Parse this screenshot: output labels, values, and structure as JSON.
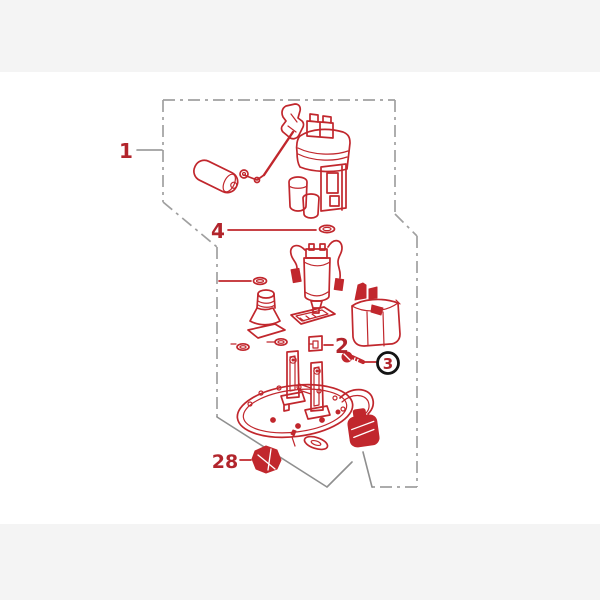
{
  "window": {
    "background": "#f4f4f4",
    "panel_background": "#ffffff"
  },
  "colors": {
    "part_line": "#c1272d",
    "part_fill": "#c1272d",
    "label_text": "#b2252c",
    "boundary": "#a0a0a0",
    "leader": "#8f8f8f",
    "callout_ring": "#141414",
    "background": "#f4f4f4",
    "panel": "#ffffff"
  },
  "diagram": {
    "kind": "exploded-parts-diagram",
    "subject": "fuel-pump-module-assembly",
    "callouts": [
      {
        "label": "1",
        "circled": false
      },
      {
        "label": "4",
        "circled": false
      },
      {
        "label": "2",
        "circled": false
      },
      {
        "label": "3",
        "circled": true
      },
      {
        "label": "28",
        "circled": false
      }
    ],
    "parts": [
      "pump-module-body",
      "fuel-level-float",
      "inner-fuel-pump",
      "strainer-joint",
      "filter-case",
      "o-rings",
      "retainer-clip",
      "flange-bolt",
      "base-plate",
      "wire-connector",
      "mounting-nut"
    ]
  }
}
